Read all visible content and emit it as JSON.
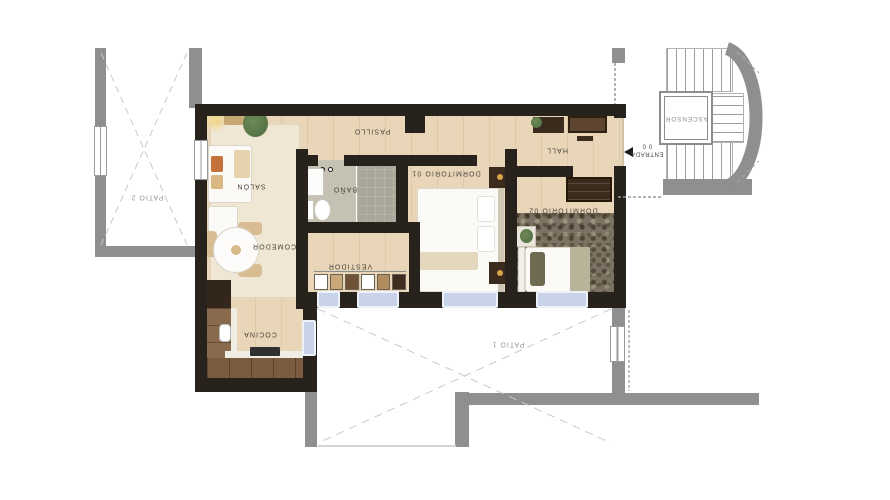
{
  "plan": {
    "rooms": [
      {
        "id": "salon",
        "label": "SALÓN"
      },
      {
        "id": "comedor",
        "label": "COMEDOR"
      },
      {
        "id": "cocina",
        "label": "COCINA"
      },
      {
        "id": "bano",
        "label": "BAÑO"
      },
      {
        "id": "vestidor",
        "label": "VESTIDOR"
      },
      {
        "id": "pasillo",
        "label": "PASILLO"
      },
      {
        "id": "hall",
        "label": "HALL"
      },
      {
        "id": "dormitorio_01",
        "label": "DORMITORIO 01"
      },
      {
        "id": "dormitorio_02",
        "label": "DORMITORIO 02"
      }
    ],
    "outdoor": [
      {
        "id": "patio_1",
        "label": "PATIO 1"
      },
      {
        "id": "patio_2",
        "label": "PATIO 2"
      }
    ],
    "core": {
      "elevator_label": "ASCENSOR",
      "entrance_label": "ENTRADA",
      "entrance_floor": "0 0"
    },
    "colors": {
      "wall_black": "#27221c",
      "wall_gray": "#8f8f8f",
      "floor_wood": "#e9d6b8",
      "rug_cream": "#efe7d3",
      "tile_gray": "#c5c2b3",
      "shower_gray": "#a8a79a",
      "carpet_dark": "#7b7263",
      "glass_blue": "#c8d3e9",
      "dash_gray": "#c9c9c9",
      "furniture_dark": "#3b2b1d",
      "cabinet_brown": "#8a6a4c",
      "plant_green": "#567446",
      "accent_orange": "#c4713a",
      "label_dark": "#4a443c",
      "label_gray": "#979792"
    }
  }
}
